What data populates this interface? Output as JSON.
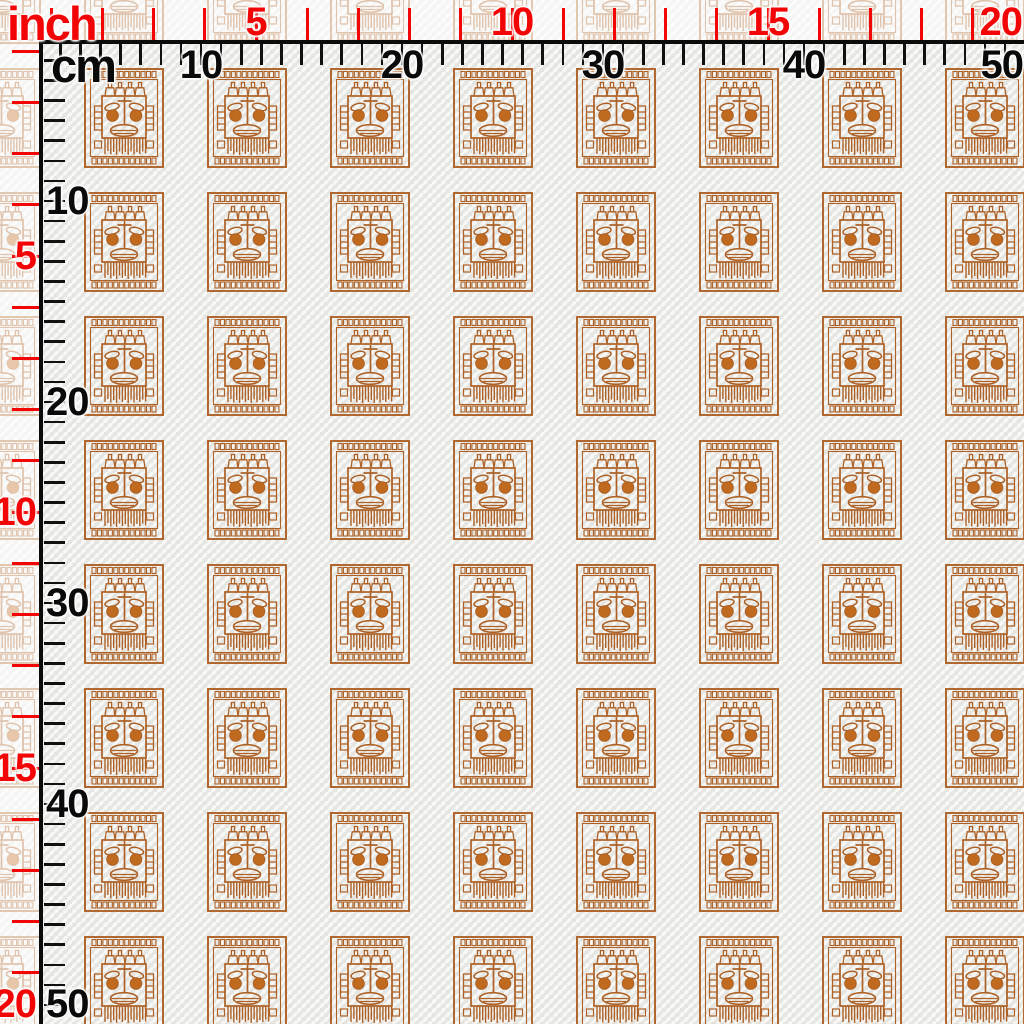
{
  "swatch": {
    "kind": "fabric-swatch-preview-with-rulers",
    "motif": "tribal-aztec-mask-stamp",
    "grid_columns": 8,
    "grid_rows": 8
  },
  "rulers": {
    "inch": {
      "title": "inch",
      "color": "#f20505",
      "px_per_unit": 51.2,
      "tick_count": 19,
      "labels": [
        {
          "text": "5",
          "at": 5
        },
        {
          "text": "10",
          "at": 10
        },
        {
          "text": "15",
          "at": 15
        },
        {
          "text": "20",
          "at": 20
        }
      ]
    },
    "cm": {
      "title": "cm",
      "color": "#0a0a0a",
      "px_per_unit": 20.1,
      "tick_count": 50,
      "labels": [
        {
          "text": "10",
          "at": 10
        },
        {
          "text": "20",
          "at": 20
        },
        {
          "text": "30",
          "at": 30
        },
        {
          "text": "40",
          "at": 40
        },
        {
          "text": "50",
          "at": 50
        }
      ]
    }
  },
  "pattern": {
    "ink_color": "#ad6126",
    "eye_fill_color": "#bf6a1e",
    "fabric_base_color": "#e5e5e2",
    "fabric_oval_color": "#f8f8f6",
    "fade_overlay_opacity": 0.62
  }
}
